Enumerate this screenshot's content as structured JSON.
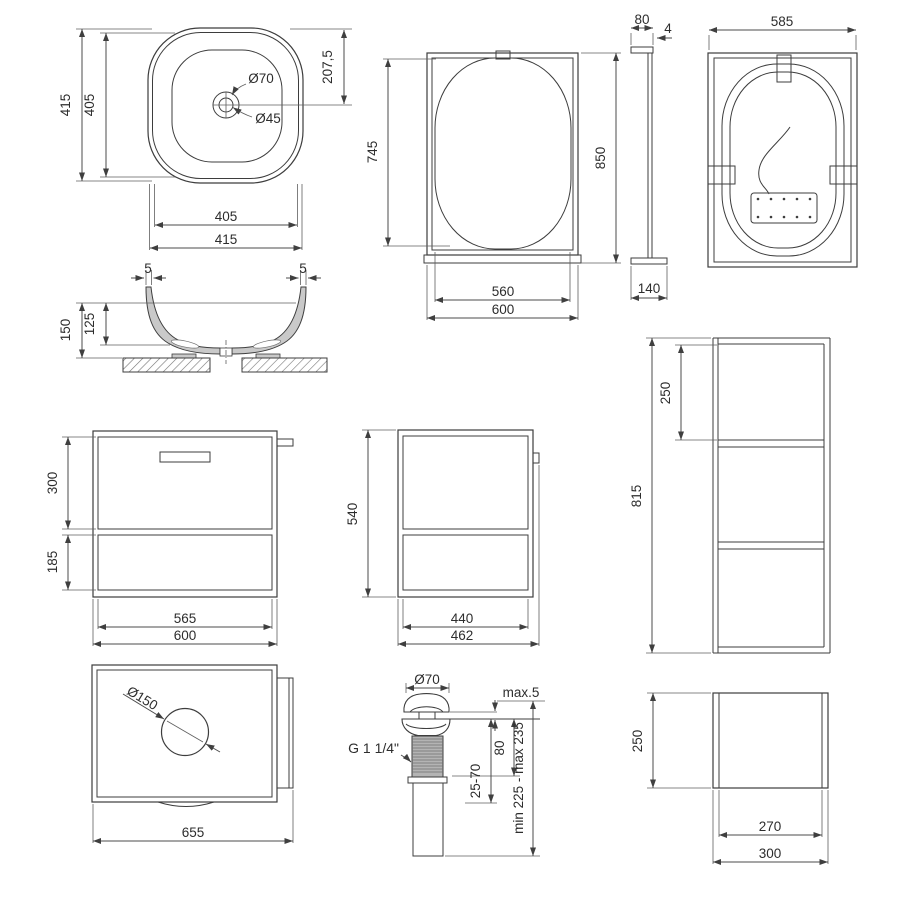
{
  "drawing": {
    "type": "technical-dimension-drawing",
    "subject": "bathroom furniture set: countertop washbasin, LED mirror, vanity cabinet, tall side shelf and pop-up drain valve",
    "colors": {
      "background": "#ffffff",
      "object_line": "#3d3d3d",
      "dimension_line": "#4b4b4b",
      "text": "#2d2d2d",
      "thread_fill": "#b4b4b4",
      "wall_fill": "#c9c9c9"
    },
    "views": {
      "sink_top": {
        "name": "washbasin top view",
        "dims": {
          "height_outer": "415",
          "height_inner": "405",
          "width_inner": "405",
          "width_outer": "415",
          "drain_offset": "207,5",
          "drain_outer": "Ø70",
          "drain_inner": "Ø45"
        }
      },
      "sink_section": {
        "name": "washbasin cross-section",
        "dims": {
          "wall_left": "5",
          "wall_right": "5",
          "height": "150",
          "depth": "125"
        }
      },
      "mirror_front": {
        "name": "mirror front view",
        "dims": {
          "glass_height": "745",
          "glass_width": "560",
          "width": "600",
          "height": "850"
        }
      },
      "mirror_side": {
        "name": "mirror side view",
        "dims": {
          "bracket_depth": "80",
          "panel_thickness": "4",
          "bottom_depth": "140"
        }
      },
      "mirror_back": {
        "name": "mirror back view",
        "dims": {
          "width": "585"
        }
      },
      "cabinet_front": {
        "name": "vanity cabinet front view",
        "dims": {
          "drawer_height": "300",
          "shelf_height": "185",
          "inner_width": "565",
          "width": "600"
        }
      },
      "cabinet_side": {
        "name": "vanity cabinet side view",
        "dims": {
          "height": "540",
          "inner_depth": "440",
          "depth": "462"
        }
      },
      "tall_cabinet": {
        "name": "open shelf column",
        "dims": {
          "section_height": "250",
          "height": "815"
        }
      },
      "cabinet_top": {
        "name": "cabinet top view",
        "dims": {
          "hole_diameter": "Ø150",
          "width": "655"
        }
      },
      "drain_valve": {
        "name": "pop-up drain valve",
        "dims": {
          "cap_diameter": "Ø70",
          "deck_gap": "max.5",
          "body_height": "80",
          "clamp_range": "25-70",
          "total_height": "min 225 - max 235",
          "thread": "G 1 1/4\""
        }
      },
      "side_shelf": {
        "name": "single shelf module",
        "dims": {
          "height": "250",
          "inner_width": "270",
          "width": "300"
        }
      }
    }
  }
}
